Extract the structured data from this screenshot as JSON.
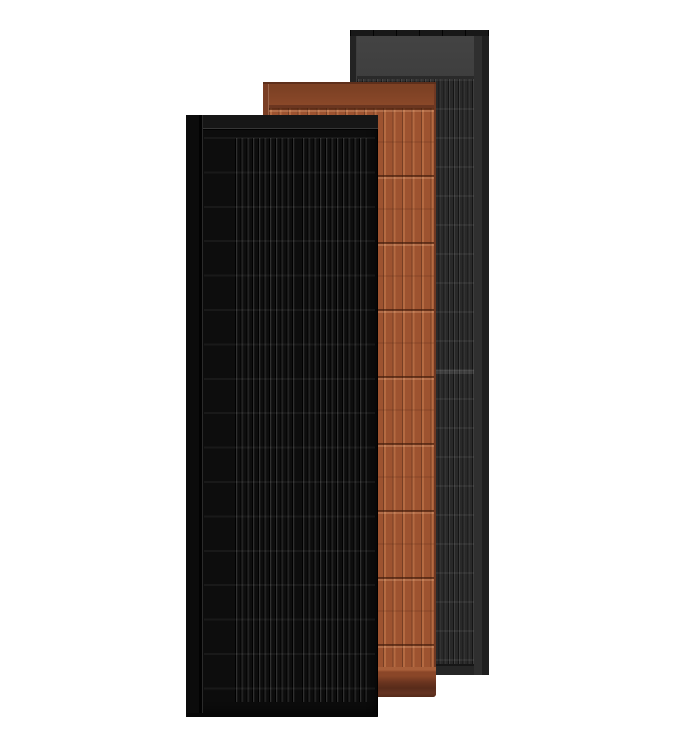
{
  "scene": {
    "background_color": "#ffffff",
    "panels": [
      {
        "name": "slate-gray-solar-panel",
        "stack_position": "back",
        "face_color": "#292929",
        "stripe_color": "#3d3d3d",
        "header_color": "#3e3e3e",
        "frame_color": "#1d1d1d"
      },
      {
        "name": "terracotta-solar-panel",
        "stack_position": "middle",
        "face_color": "#9d5330",
        "stripe_color": "#b56b42",
        "header_color": "#8a4829",
        "frame_color": "#5e2f1b"
      },
      {
        "name": "matte-black-solar-panel",
        "stack_position": "front",
        "face_color": "#0d0d0d",
        "stripe_color": "#2f2f2f",
        "header_color": "#161616",
        "frame_color": "#060606"
      }
    ]
  }
}
